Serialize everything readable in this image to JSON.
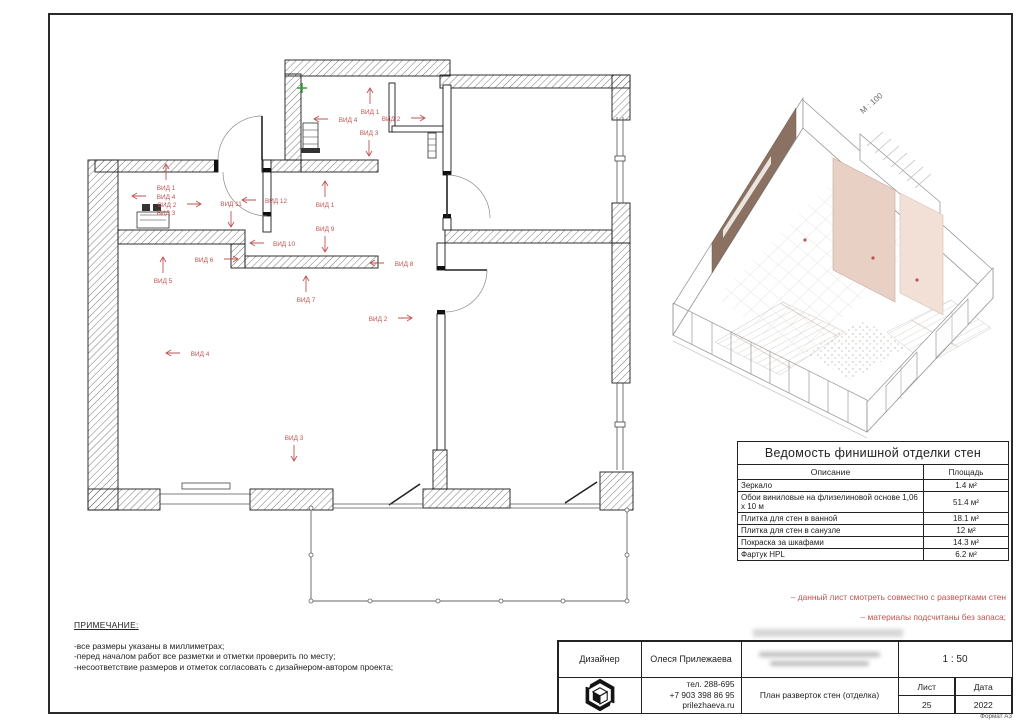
{
  "frame": {
    "format_label": "Формат А3"
  },
  "floor_plan": {
    "marker_color": "#bf5350",
    "view_markers": [
      {
        "label": "ВИД 1",
        "x": 290,
        "y": 62,
        "dir": "up"
      },
      {
        "label": "ВИД 2",
        "x": 311,
        "y": 69,
        "dir": "right"
      },
      {
        "label": "ВИД 3",
        "x": 289,
        "y": 83,
        "dir": "down"
      },
      {
        "label": "ВИД 4",
        "x": 268,
        "y": 70,
        "dir": "left"
      },
      {
        "label": "ВИД 1",
        "x": 86,
        "y": 138,
        "dir": "up"
      },
      {
        "label": "ВИД 4",
        "x": 86,
        "y": 147,
        "dir": "left"
      },
      {
        "label": "ВИД 2",
        "x": 87,
        "y": 155,
        "dir": "right"
      },
      {
        "label": "ВИД 3",
        "x": 86,
        "y": 163,
        "dir": "none"
      },
      {
        "label": "ВИД 11",
        "x": 151,
        "y": 154,
        "dir": "down"
      },
      {
        "label": "ВИД 12",
        "x": 196,
        "y": 151,
        "dir": "left"
      },
      {
        "label": "ВИД 1",
        "x": 245,
        "y": 155,
        "dir": "up"
      },
      {
        "label": "ВИД 9",
        "x": 245,
        "y": 179,
        "dir": "down"
      },
      {
        "label": "ВИД 10",
        "x": 204,
        "y": 194,
        "dir": "left"
      },
      {
        "label": "ВИД 6",
        "x": 124,
        "y": 210,
        "dir": "right"
      },
      {
        "label": "ВИД 5",
        "x": 83,
        "y": 231,
        "dir": "up"
      },
      {
        "label": "ВИД 8",
        "x": 324,
        "y": 214,
        "dir": "left"
      },
      {
        "label": "ВИД 7",
        "x": 226,
        "y": 250,
        "dir": "up"
      },
      {
        "label": "ВИД 2",
        "x": 298,
        "y": 269,
        "dir": "right"
      },
      {
        "label": "ВИД 4",
        "x": 120,
        "y": 304,
        "dir": "left"
      },
      {
        "label": "ВИД 3",
        "x": 214,
        "y": 388,
        "dir": "down"
      }
    ]
  },
  "axon_view": {
    "scale_label": "М : 100"
  },
  "finish_table": {
    "title": "Ведомость финишной отделки стен",
    "columns": [
      "Описание",
      "Площадь"
    ],
    "rows": [
      [
        "Зеркало",
        "1.4 м²"
      ],
      [
        "Обои виниловые на флизелиновой основе 1,06 х 10 м",
        "51.4 м²"
      ],
      [
        "Плитка для стен в ванной",
        "18.1 м²"
      ],
      [
        "Плитка для стен в санузле",
        "12 м²"
      ],
      [
        "Покраска за шкафами",
        "14.3 м²"
      ],
      [
        "Фартук HPL",
        "6.2 м²"
      ]
    ]
  },
  "notes": {
    "title": "ПРИМЕЧАНИЕ:",
    "items": [
      "-все размеры указаны в миллиметрах;",
      "-перед началом работ все разметки и отметки проверить по месту;",
      "-несоответствие размеров и отметок согласовать с дизайнером-автором проекта;"
    ]
  },
  "red_notes": [
    "– данный лист смотреть совместно с развертками стен",
    "– материалы подсчитаны без запаса;"
  ],
  "title_block": {
    "designer_label": "Дизайнер",
    "designer_name": "Олеся Прилежаева",
    "scale": "1 : 50",
    "contacts": [
      "тел. 288-695",
      "+7 903 398 86 95",
      "prilezhaeva.ru"
    ],
    "drawing_title": "План разверток стен (отделка)",
    "sheet_label": "Лист",
    "date_label": "Дата",
    "sheet_number": "25",
    "date_value": "2022"
  }
}
